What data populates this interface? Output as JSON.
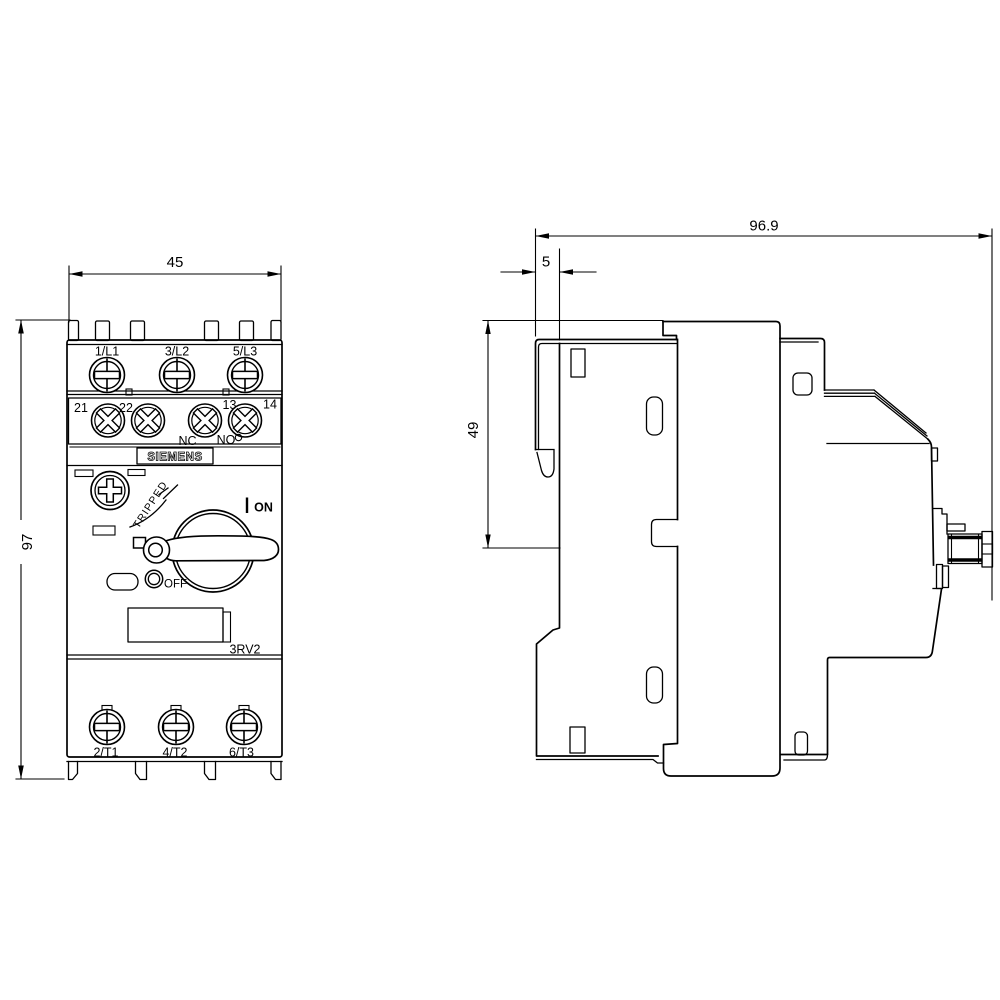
{
  "page": {
    "background": "#ffffff",
    "line_color": "#000000"
  },
  "front_view": {
    "dim_width": "45",
    "dim_height": "97",
    "line_terminals": [
      "1/L1",
      "3/L2",
      "5/L3"
    ],
    "aux_terminals": [
      "21",
      "22",
      "13",
      "14"
    ],
    "aux_nc": "NC",
    "aux_no": "NO",
    "brand": "SIEMENS",
    "tripped_label": "TRIPPED",
    "on_label": "ON",
    "off_label": "OFF",
    "model": "3RV2",
    "load_terminals": [
      "2/T1",
      "4/T2",
      "6/T3"
    ]
  },
  "side_view": {
    "dim_depth": "96.9",
    "dim_clip": "5",
    "dim_height_upper": "49"
  }
}
